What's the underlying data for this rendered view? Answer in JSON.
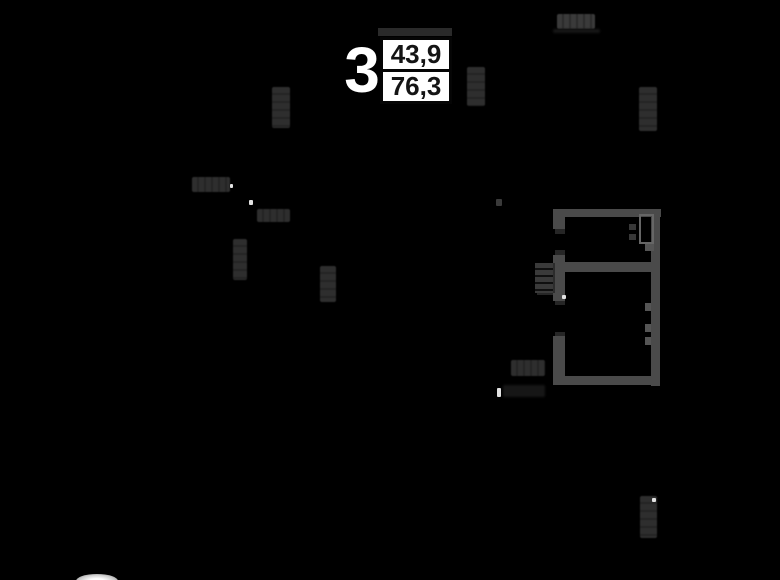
{
  "image_type": "apartment-floor-plan-on-black",
  "apartment_label": {
    "rooms": "3",
    "area_top": "43,9",
    "area_bottom": "76,3"
  },
  "colors": {
    "background": "#000000",
    "wall": "#4a4a4a",
    "dimension_smudge": "#2e2e2e",
    "label_box_background": "#ffffff",
    "label_box_border": "#050505",
    "label_number_color": "#141414",
    "rooms_number_color": "#ffffff",
    "white_dot": "#e2e2e2"
  }
}
